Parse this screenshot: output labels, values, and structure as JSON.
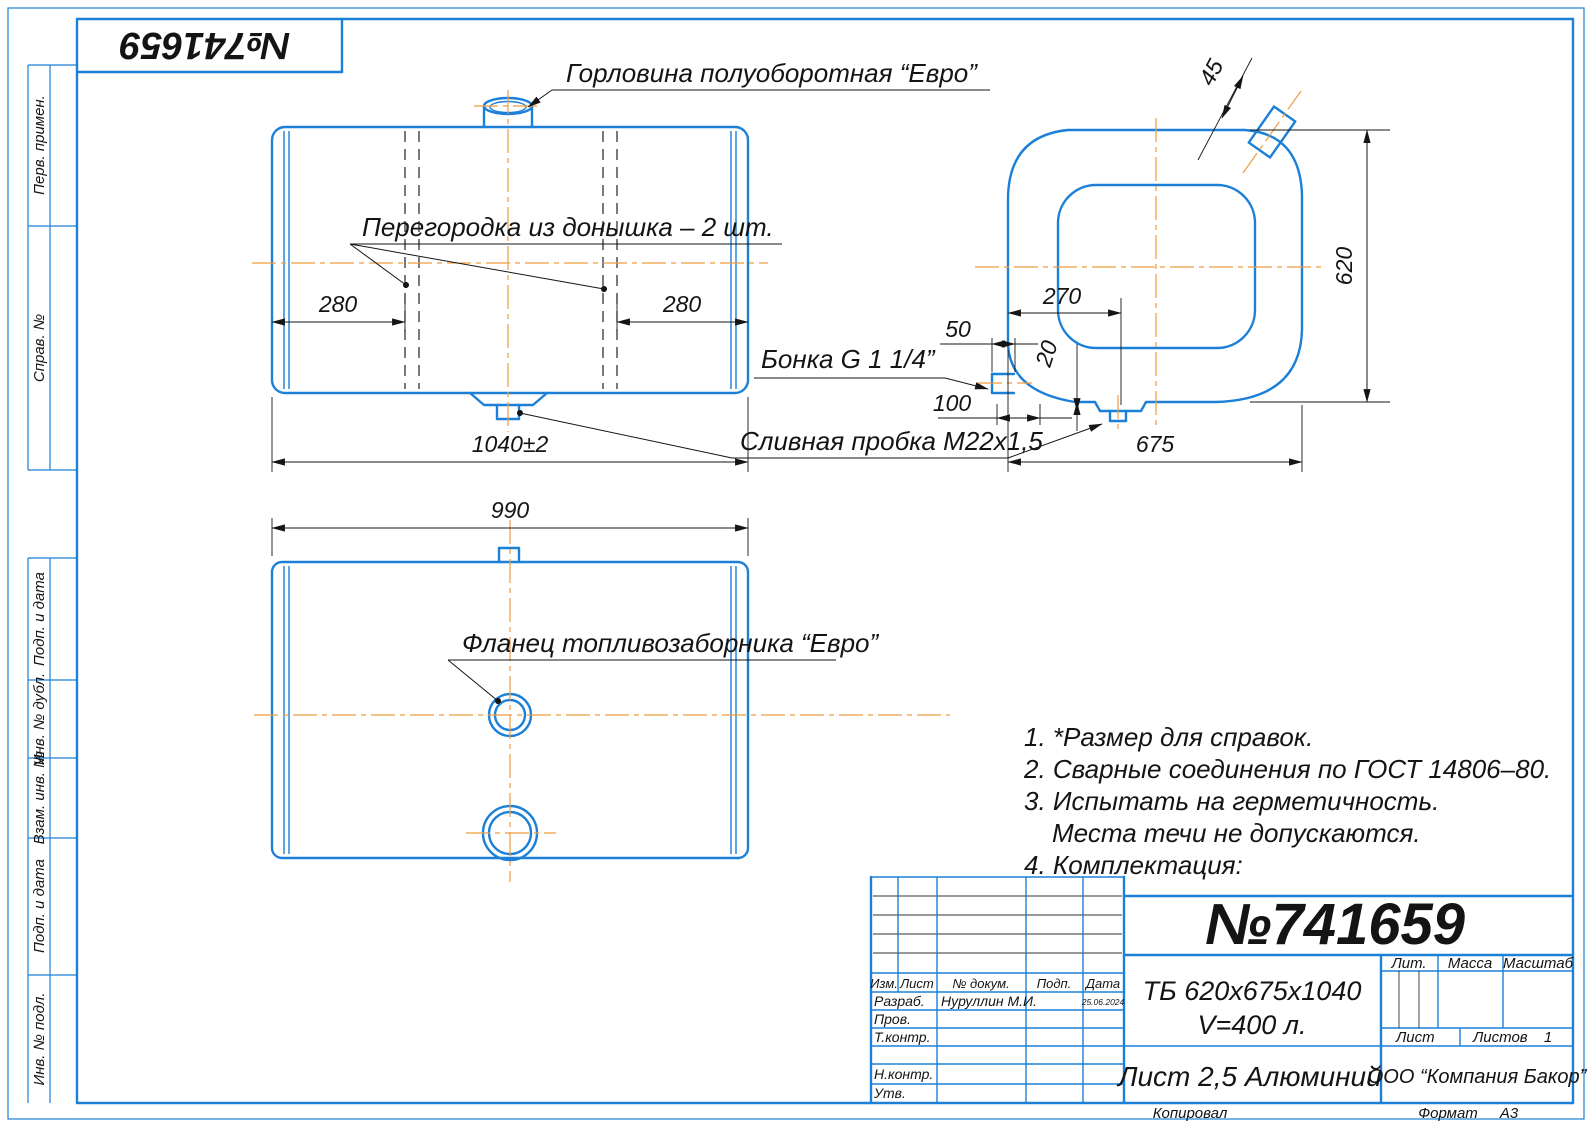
{
  "sheet": {
    "stamp_number": "№741659",
    "copied_label": "Копировал",
    "format_label": "Формат",
    "format_value": "А3"
  },
  "margin_labels": {
    "perv_primen": "Перв. примен.",
    "sprav_no": "Справ. №",
    "podp_data_top": "Подп. и дата",
    "inv_dubl": "Инв. № дубл.",
    "vzam_inv": "Взам. инв. №",
    "podp_data_bottom": "Подп. и дата",
    "inv_podl": "Инв. № подл."
  },
  "callouts": {
    "filler_neck": "Горловина полуоборотная “Евро”",
    "baffle": "Перегородка из донышка – 2 шт.",
    "bonka": "Бонка G 1 1/4”",
    "drain_plug": "Сливная пробка М22х1,5",
    "fuel_flange": "Фланец топливозаборника “Евро”"
  },
  "dimensions": {
    "baffle_left": "280",
    "baffle_right": "280",
    "tank_length": "1040±2",
    "bottom_width": "990",
    "side_to_drain": "270",
    "bonka_offset": "50",
    "drain_depth": "20",
    "bonka_height": "100",
    "tank_height": "620",
    "tank_depth": "675",
    "neck_angle": "45"
  },
  "notes": {
    "n1": "1. *Размер для справок.",
    "n2": "2. Сварные соединения по ГОСТ 14806–80.",
    "n3": "3. Испытать на герметичность.",
    "n3b": "Места течи не допускаются.",
    "n4": "4. Комплектация:"
  },
  "title_block": {
    "doc_number": "№741659",
    "designation": "ТБ 620х675х1040",
    "volume": "V=400 л.",
    "material": "Лист 2,5 Алюминий",
    "company": "ООО “Компания Бакор”",
    "col_izm": "Изм.",
    "col_list": "Лист",
    "col_dokum": "№ докум.",
    "col_podp": "Подп.",
    "col_data": "Дата",
    "row_razrab": "Разраб.",
    "razrab_name": "Нуруллин М.И.",
    "razrab_date": "25.06.2024",
    "row_prov": "Пров.",
    "row_tkontr": "Т.контр.",
    "row_nkontr": "Н.контр.",
    "row_utv": "Утв.",
    "lit_label": "Лит.",
    "massa_label": "Масса",
    "masshtab_label": "Масштаб",
    "list_label": "Лист",
    "listov_label": "Листов",
    "listov_value": "1"
  }
}
